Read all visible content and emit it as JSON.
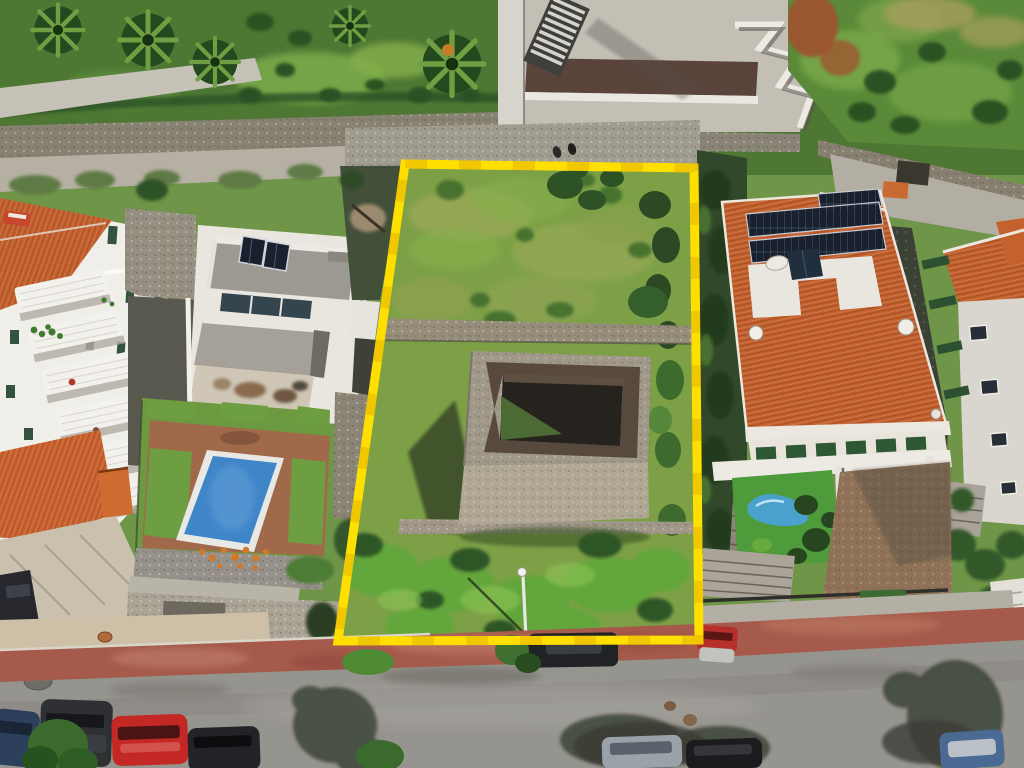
{
  "meta": {
    "type": "aerial-drone-photograph",
    "subject": "residential building plot outlined with yellow boundary"
  },
  "colors": {
    "boundary_yellow": "#ffdf00",
    "boundary_shade": "#d89f00",
    "plot_grass": "#7da047",
    "roof_orange": "#c2602e",
    "pool_blue": "#3f86c8",
    "road_gray": "#96948e",
    "sidewalk_red": "#a65a4b",
    "solar_panel": "#18212d",
    "artificial_lawn": "#4d9b3b",
    "stone": "#9d9585"
  },
  "boundary": {
    "shape": "quadrilateral",
    "points": "405,164 694,168 699,640 338,641",
    "stroke_width": 9
  },
  "plot_features": [
    "overgrown grass",
    "ruined stone water tank",
    "stone terrace walls",
    "lamp post"
  ],
  "surroundings": [
    "white apartment block with balconies",
    "modern white house with solar panels and pool",
    "orange tiled roof house with photovoltaic array",
    "far-right house with skylights",
    "concrete building with staircase",
    "green hillside",
    "street with parked cars",
    "red sidewalk",
    "trees and palm trees"
  ]
}
